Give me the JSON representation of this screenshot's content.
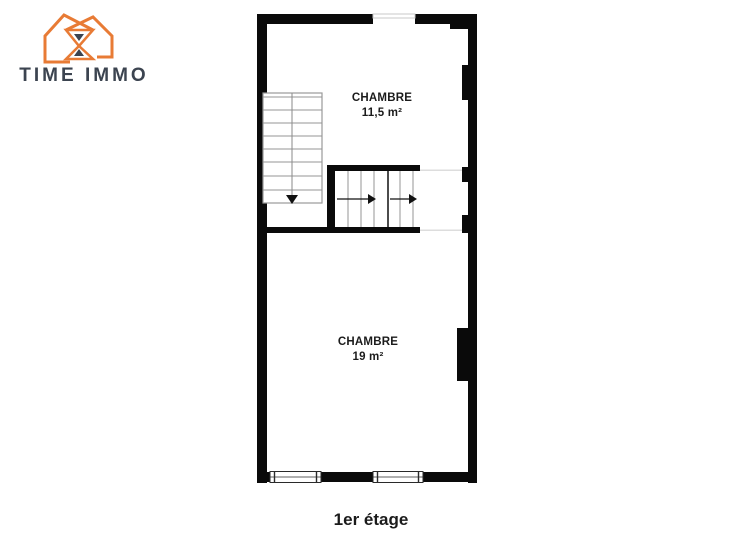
{
  "brand": {
    "name": "TIME IMMO",
    "accent_color": "#e87b35",
    "text_color": "#3c4450"
  },
  "plan": {
    "wall_color": "#0a0a0a",
    "stair_line_color": "#949494",
    "rooms": [
      {
        "name": "CHAMBRE",
        "area": "11,5 m²"
      },
      {
        "name": "CHAMBRE",
        "area": "19 m²"
      }
    ],
    "floor_label": "1er étage"
  },
  "icons": [
    {
      "name": "logo-houses-icon",
      "meaning": "two orange house outlines with hourglass"
    },
    {
      "name": "staircase-vertical-icon",
      "meaning": "stair flight going down"
    },
    {
      "name": "staircase-horizontal-icon",
      "meaning": "stair flight going right"
    },
    {
      "name": "window-icon",
      "meaning": "window symbol in wall"
    }
  ]
}
